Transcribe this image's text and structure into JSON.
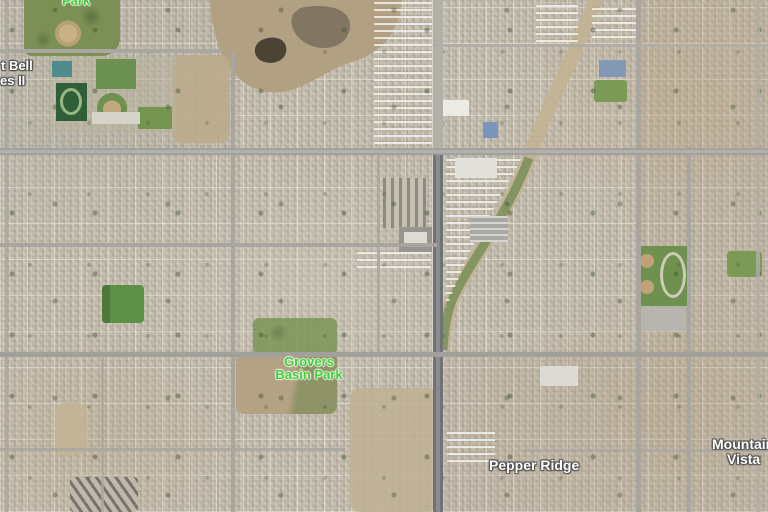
{
  "map": {
    "view": "satellite",
    "labels": {
      "park": "Park",
      "bell_line1": "t Bell",
      "bell_line2": "es II",
      "grovers_line1": "Grovers",
      "grovers_line2": "Basin Park",
      "pepper_ridge": "Pepper Ridge",
      "mountain_line1": "Mountain",
      "mountain_line2": "Vista"
    }
  },
  "colors": {
    "park_label": "#3ecf3e",
    "place_label": "#ffffff",
    "label_halo": "#4d4d4d",
    "ground": "#c6bfb0",
    "desert": "#b2a082",
    "park_green": "#6f9150",
    "major_road": "#74767a"
  }
}
